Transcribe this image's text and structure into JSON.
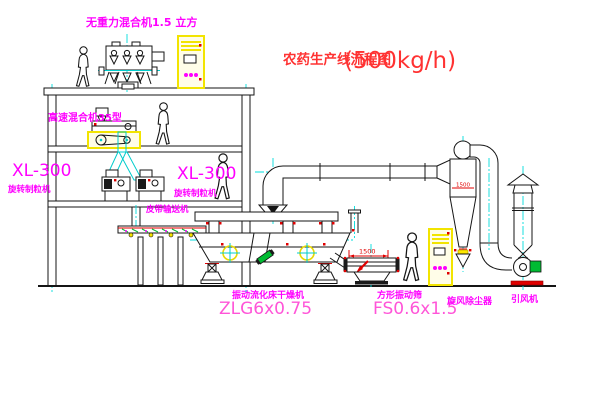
{
  "title": {
    "name_cn": "农药生产线流程图",
    "capacity": "(500kg/h)"
  },
  "labels": {
    "gravity_mixer": "无重力混合机1.5 立方",
    "high_speed_mixer": "高速混合机35型",
    "xl300_left": "XL-300",
    "granulator_left": "旋转制粒机",
    "xl300_center": "XL-300",
    "granulator_center": "旋转制粒机",
    "belt_conveyor": "皮带输送机",
    "dryer_name": "振动流化床干燥机",
    "dryer_model": "ZLG6x0.75",
    "screen_dim": "1500",
    "screen_name": "方形振动筛",
    "screen_model": "FS0.6x1.5",
    "cyclone_dim": "1500",
    "cyclone": "旋风除尘器",
    "fan": "引风机"
  },
  "colors": {
    "line": "#151515",
    "centerline": "#00dcdc",
    "label_magenta": "#ff00ff",
    "model_pink": "#ff55d8",
    "title_red": "#ff3232",
    "highlight_yellow": "#f2e400",
    "accent_red": "#e00000",
    "accent_green": "#00bb33",
    "background": "#ffffff"
  }
}
